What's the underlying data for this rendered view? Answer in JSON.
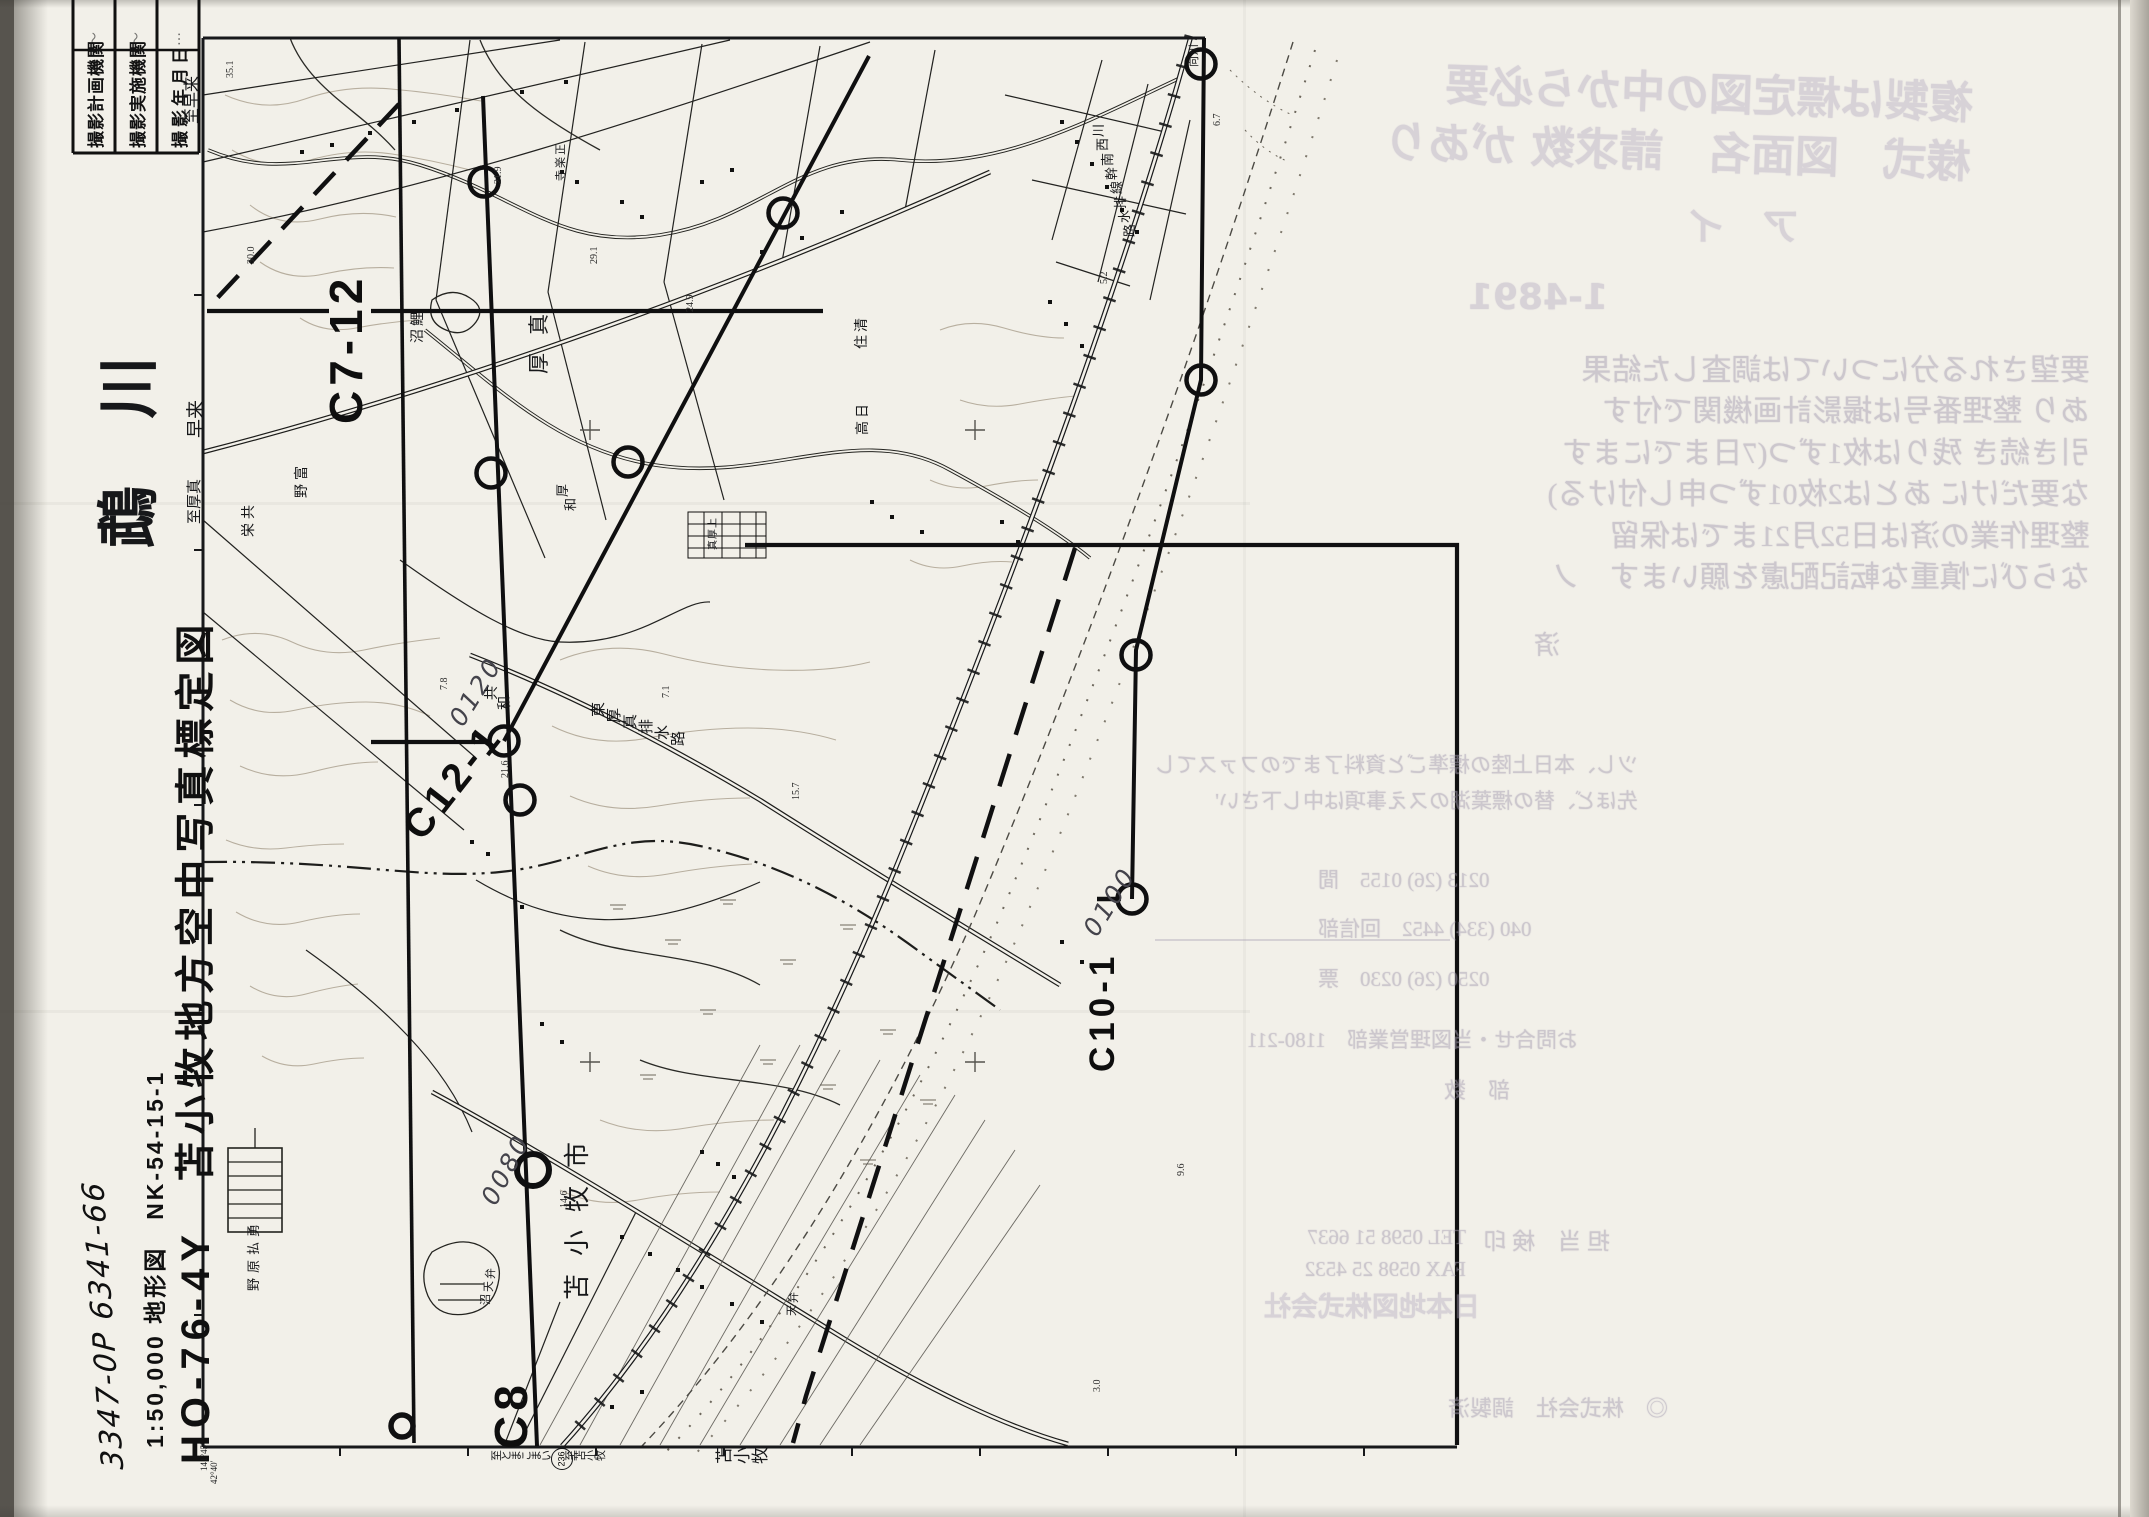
{
  "document": {
    "kind": "scanned aerial-photograph plot index map sheet (rotated 90°)",
    "paper_color": "#f2f0e9",
    "ink_color": "#17181a",
    "contour_color": "#b4ab9b",
    "bleed_color": "#a79fb2"
  },
  "header_table": {
    "rows": [
      {
        "label": "撮影計画機関",
        "value": "〜"
      },
      {
        "label": "撮影実施機関",
        "value": "〜"
      },
      {
        "label": "撮影年月日",
        "value": "…"
      }
    ]
  },
  "title_block": {
    "handwritten_number": "3347-0P  6341-66",
    "map_series": "1:50,000 地形図　NK-54-15-1",
    "main_title": "HO-76-4Y　苫小牧地方空中写真標定図"
  },
  "flight_courses": [
    {
      "id": "C7-12"
    },
    {
      "id": "C12-1"
    },
    {
      "id": "C8"
    },
    {
      "id": "C10-1"
    }
  ],
  "handwritten_photo_numbers": [
    "0120",
    "0080",
    "0100"
  ],
  "route_shield": "236",
  "corner_coordinates": [
    "141°45′",
    "42°40′"
  ],
  "labels": [
    {
      "n": "label-to-hayakita",
      "t": "至早来",
      "x": 185,
      "y": 124,
      "s": 16,
      "m": "v",
      "c": "ser"
    },
    {
      "n": "title-mukawa-river",
      "t": "鵡 川",
      "x": 99,
      "y": 548,
      "s": 62,
      "m": "v",
      "c": "ser b sp"
    },
    {
      "n": "label-hayakita",
      "t": "早来",
      "x": 187,
      "y": 438,
      "s": 19,
      "m": "v",
      "c": "ser"
    },
    {
      "n": "label-to-atsuma",
      "t": "至厚真",
      "x": 188,
      "y": 524,
      "s": 15,
      "m": "v",
      "c": "ser"
    },
    {
      "n": "course-label-c7-12",
      "t": "C7-12",
      "x": 323,
      "y": 424,
      "s": 46,
      "m": "v",
      "c": "course"
    },
    {
      "n": "course-label-c12-1",
      "t": "C12-1",
      "x": 396,
      "y": 822,
      "s": 40,
      "m": "v",
      "c": "course",
      "a": -52
    },
    {
      "n": "course-label-c8",
      "t": "C8",
      "x": 488,
      "y": 1449,
      "s": 46,
      "m": "v",
      "c": "course"
    },
    {
      "n": "course-label-c10-1",
      "t": "C10-1",
      "x": 1085,
      "y": 1072,
      "s": 35,
      "m": "v",
      "c": "course"
    },
    {
      "n": "photo-number-0120",
      "t": "0120",
      "x": 445,
      "y": 717,
      "s": 25,
      "m": "v",
      "c": "hand",
      "a": -58
    },
    {
      "n": "photo-number-0080",
      "t": "0080",
      "x": 477,
      "y": 1197,
      "s": 25,
      "m": "v",
      "c": "hand",
      "a": -62
    },
    {
      "n": "photo-number-0100",
      "t": "0100",
      "x": 1079,
      "y": 927,
      "s": 25,
      "m": "v",
      "c": "hand",
      "a": -58
    },
    {
      "n": "label-tomakomai-city",
      "t": "苫小牧市",
      "x": 565,
      "y": 1300,
      "s": 26,
      "m": "v",
      "c": "ser sp2"
    },
    {
      "n": "label-atsuma-town",
      "t": "厚真",
      "x": 529,
      "y": 374,
      "s": 21,
      "m": "v",
      "c": "ser sp2"
    },
    {
      "n": "coordinate-141-45",
      "t": "141°45′",
      "x": 200,
      "y": 1471,
      "s": 9,
      "m": "v",
      "c": "ser"
    },
    {
      "n": "coordinate-42-40",
      "t": "42°40′",
      "x": 210,
      "y": 1484,
      "s": 9,
      "m": "v",
      "c": "ser"
    },
    {
      "n": "label-kyoei",
      "t": "共栄",
      "x": 243,
      "y": 505,
      "s": 14,
      "m": "r",
      "a": 90,
      "g": 4
    },
    {
      "n": "label-tomino",
      "t": "富野",
      "x": 296,
      "y": 466,
      "s": 14,
      "m": "r",
      "a": 90,
      "g": 4
    },
    {
      "n": "label-koinuma",
      "t": "鯉沼",
      "x": 412,
      "y": 312,
      "s": 14,
      "m": "r",
      "a": 90,
      "g": 3
    },
    {
      "n": "label-shorakuji",
      "t": "正楽寺",
      "x": 556,
      "y": 144,
      "s": 11,
      "m": "r",
      "a": 90,
      "g": 2
    },
    {
      "n": "label-kyowa",
      "t": "共和",
      "x": 486,
      "y": 686,
      "s": 14,
      "m": "r",
      "a": 38,
      "g": 3
    },
    {
      "n": "label-atsuwa",
      "t": "厚和",
      "x": 556,
      "y": 484,
      "s": 13,
      "m": "r",
      "a": 62,
      "g": 3
    },
    {
      "n": "label-kiyozumi",
      "t": "清住",
      "x": 856,
      "y": 318,
      "s": 14,
      "m": "r",
      "a": 90,
      "g": 3
    },
    {
      "n": "label-hidaka",
      "t": "日高",
      "x": 857,
      "y": 404,
      "s": 14,
      "m": "r",
      "a": 90,
      "g": 3
    },
    {
      "n": "label-higashi-atsuma-drainage",
      "t": "東厚真排水路",
      "x": 592,
      "y": 702,
      "s": 15,
      "m": "r",
      "a": 20,
      "g": 2
    },
    {
      "n": "label-kawanishi-trunk-drainage",
      "t": "川西南幹線排水路",
      "x": 1092,
      "y": 124,
      "s": 13,
      "m": "r",
      "a": 73,
      "g": 2
    },
    {
      "n": "label-benten-numa",
      "t": "弁天沼",
      "x": 486,
      "y": 1268,
      "s": 11,
      "m": "r",
      "a": 100,
      "g": 2
    },
    {
      "n": "label-benten",
      "t": "弁天",
      "x": 789,
      "y": 1292,
      "s": 11,
      "m": "r",
      "a": 100,
      "g": 2
    },
    {
      "n": "label-yufutsu-plain",
      "t": "勇払原野",
      "x": 247,
      "y": 1224,
      "s": 13,
      "m": "r",
      "a": 90,
      "g": 5
    },
    {
      "n": "label-kami-atsuma",
      "t": "上厚真",
      "x": 709,
      "y": 518,
      "s": 10,
      "m": "r",
      "a": 90,
      "g": 1
    },
    {
      "n": "label-kawamukai",
      "t": "川向",
      "x": 1189,
      "y": 44,
      "s": 11,
      "m": "r",
      "a": 90,
      "g": 1
    },
    {
      "n": "border-label-to-tomakomai-kana",
      "t": "至とまこまい",
      "x": 492,
      "y": 1450,
      "s": 11,
      "m": "r",
      "a": 0,
      "g": -1
    },
    {
      "n": "border-label-to-tomakomai",
      "t": "至苫小牧",
      "x": 566,
      "y": 1450,
      "s": 11,
      "m": "r",
      "a": 0,
      "g": -1
    },
    {
      "n": "border-label-tomakomai",
      "t": "苫小牧",
      "x": 716,
      "y": 1447,
      "s": 17,
      "m": "r",
      "a": 0,
      "g": 1
    },
    {
      "n": "route-shield-236",
      "t": "236",
      "x": 551,
      "y": 1448,
      "s": 9,
      "m": "shield"
    },
    {
      "n": "spot-height",
      "t": "35.1",
      "x": 226,
      "y": 78,
      "s": 10,
      "m": "v",
      "c": "spot"
    },
    {
      "n": "spot-height",
      "t": "30.0",
      "x": 247,
      "y": 264,
      "s": 10,
      "m": "v",
      "c": "spot"
    },
    {
      "n": "spot-height",
      "t": "21.9",
      "x": 494,
      "y": 184,
      "s": 10,
      "m": "v",
      "c": "spot"
    },
    {
      "n": "spot-height",
      "t": "29.1",
      "x": 590,
      "y": 264,
      "s": 10,
      "m": "v",
      "c": "spot"
    },
    {
      "n": "spot-height",
      "t": "24.9",
      "x": 686,
      "y": 312,
      "s": 10,
      "m": "v",
      "c": "spot"
    },
    {
      "n": "spot-height",
      "t": "7.8",
      "x": 440,
      "y": 690,
      "s": 10,
      "m": "v",
      "c": "spot"
    },
    {
      "n": "spot-height",
      "t": "7.1",
      "x": 662,
      "y": 698,
      "s": 10,
      "m": "v",
      "c": "spot"
    },
    {
      "n": "spot-height",
      "t": "15.7",
      "x": 792,
      "y": 800,
      "s": 10,
      "m": "v",
      "c": "spot"
    },
    {
      "n": "spot-height",
      "t": "21.6",
      "x": 501,
      "y": 778,
      "s": 10,
      "m": "v",
      "c": "spot"
    },
    {
      "n": "spot-height",
      "t": "14.6",
      "x": 560,
      "y": 1208,
      "s": 10,
      "m": "v",
      "c": "spot"
    },
    {
      "n": "spot-height",
      "t": "6.7",
      "x": 1213,
      "y": 126,
      "s": 10,
      "m": "v",
      "c": "spot"
    },
    {
      "n": "spot-height",
      "t": "5.2",
      "x": 1100,
      "y": 284,
      "s": 10,
      "m": "v",
      "c": "spot"
    },
    {
      "n": "spot-height",
      "t": "9.6",
      "x": 1177,
      "y": 1176,
      "s": 10,
      "m": "v",
      "c": "spot"
    },
    {
      "n": "spot-height",
      "t": "3.0",
      "x": 1093,
      "y": 1392,
      "s": 10,
      "m": "v",
      "c": "spot"
    }
  ],
  "bleed_text": {
    "note": "mirrored ink transfer from facing page",
    "blocks": [
      {
        "n": "bleed-heading-1",
        "x": 1252,
        "y": 62,
        "w": 720,
        "s": 44,
        "r": -2,
        "c": "hd",
        "lines": [
          "複製は標定図の中から必要",
          "様式　図面名　請求数 があり"
        ]
      },
      {
        "n": "bleed-heading-2",
        "x": 1540,
        "y": 202,
        "w": 260,
        "s": 38,
        "c": "hd",
        "lines": [
          "ア　イ"
        ]
      },
      {
        "n": "bleed-number",
        "x": 1368,
        "y": 274,
        "w": 240,
        "s": 36,
        "c": "hd",
        "lines": [
          "1-4891"
        ]
      },
      {
        "n": "bleed-paragraph",
        "x": 1230,
        "y": 350,
        "w": 860,
        "s": 30,
        "lh": 1.38,
        "lines": [
          "要望される分については調査した結果",
          "あり 整理番号は撮影計画機関で付す",
          "引き続き 残りは枚1ずつ(7日までにます",
          "な要だけに あとは2枚01ずつ申し付ける)",
          "整理作業の済は日52月21までは保留",
          "ならびに慎重な転記配慮を願います　ノ"
        ]
      },
      {
        "n": "bleed-sumi",
        "x": 1480,
        "y": 628,
        "w": 80,
        "s": 26,
        "lines": [
          "済"
        ]
      },
      {
        "n": "bleed-smallpair",
        "x": 1148,
        "y": 748,
        "w": 490,
        "s": 21,
        "lh": 1.7,
        "lines": [
          "ツし、本日上陸の標準ごと資料了までのファスてし",
          "先ほど、替の標葉湖のスえ事項は中し下さい'"
        ]
      },
      {
        "n": "bleed-phone-list",
        "x": 1318,
        "y": 856,
        "w": 235,
        "s": 21,
        "lh": 2.35,
        "al": "right",
        "lines": [
          "0213 (26) 0155　間",
          "040 (334) 4452　回信部",
          "0250 (26) 0230　票"
        ]
      },
      {
        "n": "bleed-contact",
        "x": 1268,
        "y": 1026,
        "w": 310,
        "s": 21,
        "lines": [
          "お問合せ・当図理営業部　1180-211"
        ]
      },
      {
        "n": "bleed-busuu",
        "x": 1380,
        "y": 1076,
        "w": 130,
        "s": 22,
        "lines": [
          "部　数"
        ]
      },
      {
        "n": "bleed-tel",
        "x": 1256,
        "y": 1222,
        "w": 210,
        "s": 21,
        "lh": 1.5,
        "lines": [
          "TEL 0598 51 6637",
          "FAX 0598 25 4532"
        ]
      },
      {
        "n": "bleed-tanto",
        "x": 1430,
        "y": 1226,
        "w": 180,
        "s": 23,
        "lines": [
          "担 当　検 印"
        ]
      },
      {
        "n": "bleed-company",
        "x": 1260,
        "y": 1290,
        "w": 220,
        "s": 27,
        "c": "hd",
        "lines": [
          "日本地図株式会社"
        ]
      },
      {
        "n": "bleed-stamp",
        "x": 1428,
        "y": 1394,
        "w": 240,
        "s": 22,
        "lines": [
          "◎　株式会社　調製済"
        ]
      }
    ]
  }
}
